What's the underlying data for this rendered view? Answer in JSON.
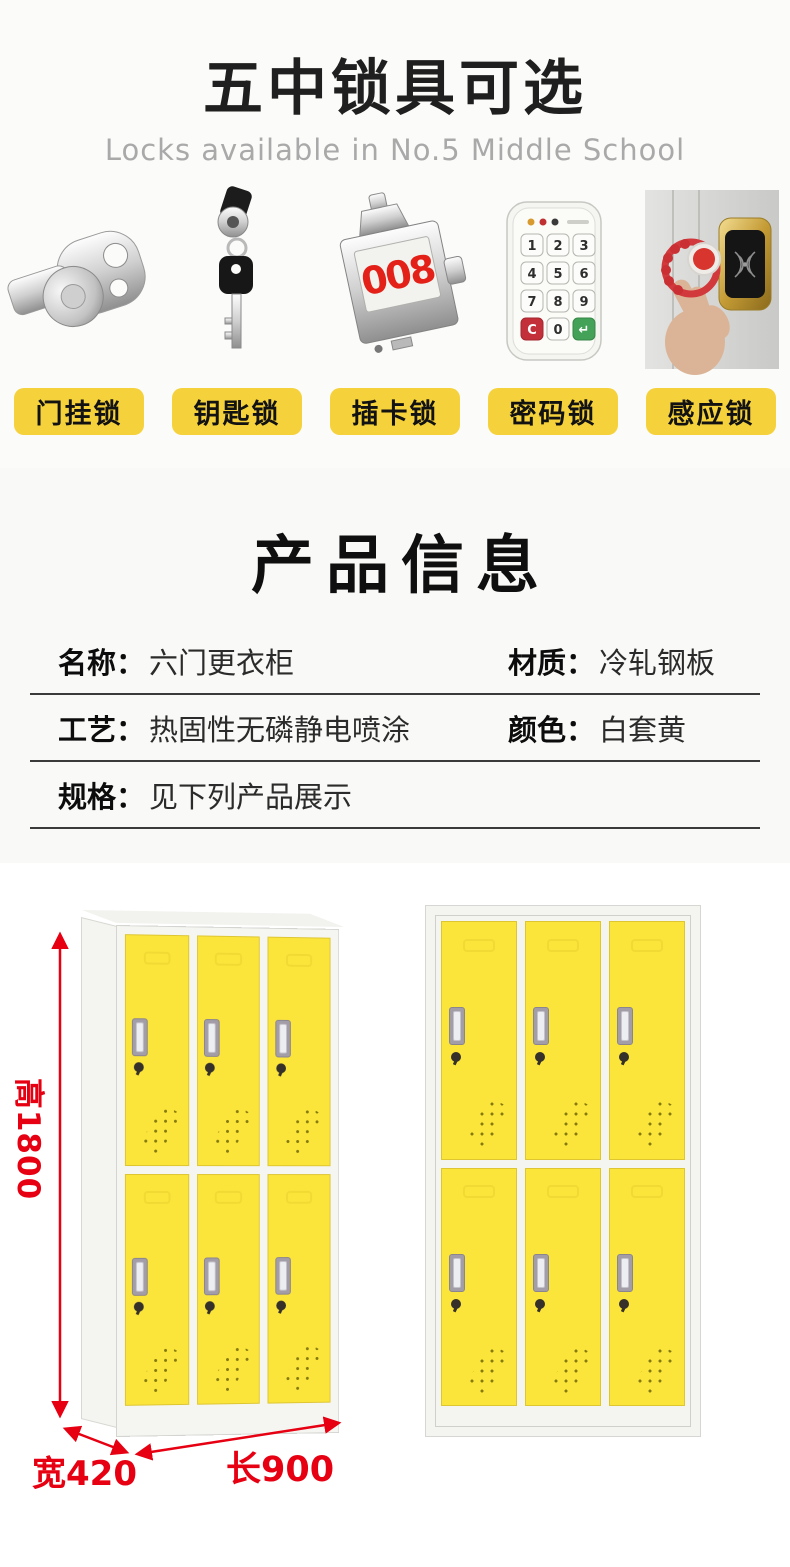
{
  "header": {
    "title": "五中锁具可选",
    "subtitle": "Locks available in No.5 Middle School"
  },
  "locks": {
    "labels": [
      "门挂锁",
      "钥匙锁",
      "插卡锁",
      "密码锁",
      "感应锁"
    ],
    "card_lock_number": "008",
    "keypad_keys": [
      "1",
      "2",
      "3",
      "4",
      "5",
      "6",
      "7",
      "8",
      "9",
      "C",
      "0",
      "↵"
    ]
  },
  "product_info": {
    "title": "产品信息",
    "rows": [
      {
        "label1": "名称：",
        "value1": "六门更衣柜",
        "label2": "材质：",
        "value2": "冷轧钢板"
      },
      {
        "label1": "工艺：",
        "value1": "热固性无磷静电喷涂",
        "label2": "颜色：",
        "value2": "白套黄"
      },
      {
        "label1": "规格：",
        "value1": "见下列产品展示"
      }
    ]
  },
  "lockers": {
    "door_count_per_unit": 6,
    "dim_height": "高1800",
    "dim_width": "宽420",
    "dim_length": "长900"
  },
  "colors": {
    "chip_yellow": "#f5d13b",
    "door_yellow": "#fce53b",
    "dimension_red": "#e60012"
  }
}
